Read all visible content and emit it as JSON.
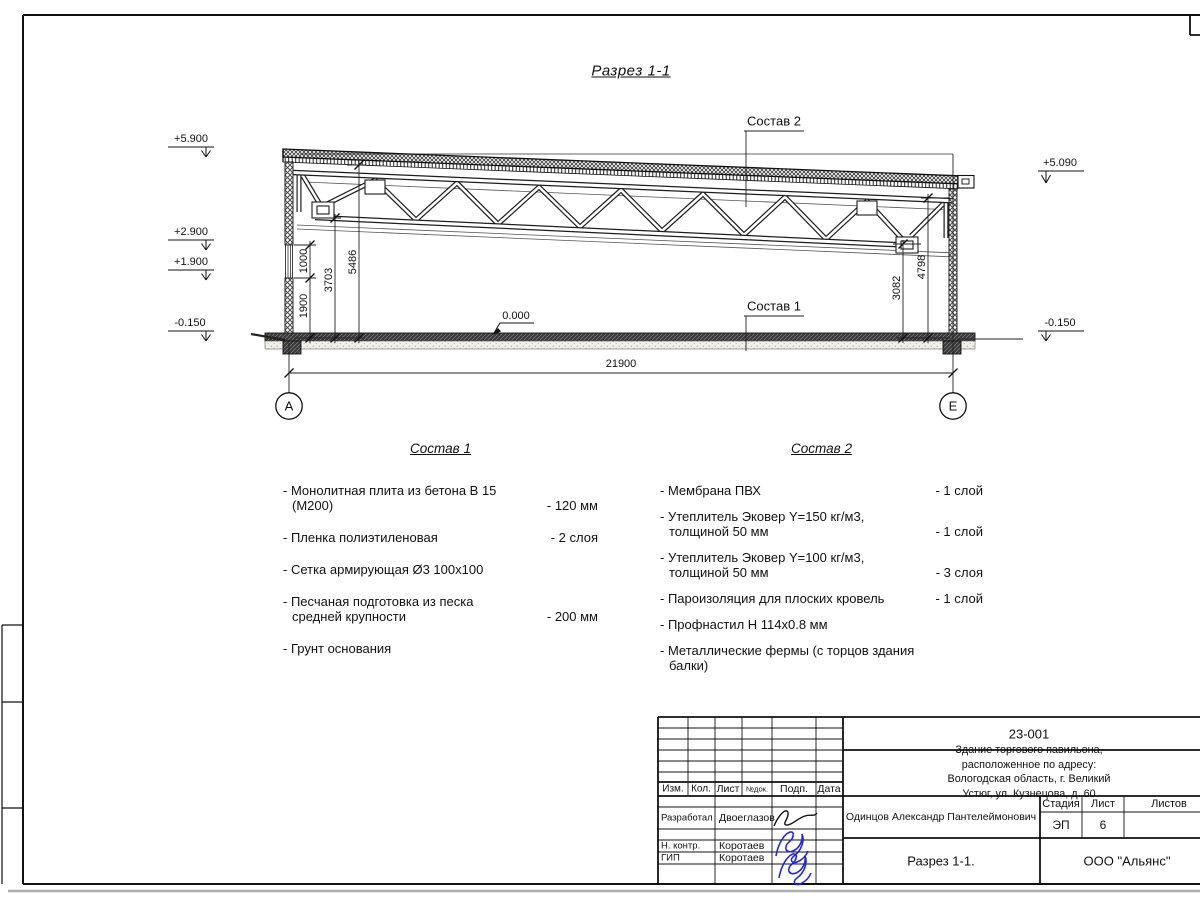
{
  "section": {
    "title": "Разрез 1-1",
    "composition1_label": "Состав 1",
    "composition2_label": "Состав 2",
    "zero_level": "0.000",
    "elevations": {
      "left_roof": "+5.900",
      "left_window_top": "+2.900",
      "left_window_sill": "+1.900",
      "left_ground": "-0.150",
      "right_roof": "+5.090",
      "right_ground": "-0.150"
    },
    "dimensions": {
      "wall_1900": "1900",
      "window_1000": "1000",
      "truss_bottom_left": "3703",
      "roof_left": "5486",
      "truss_bottom_right": "3082",
      "roof_right": "4798",
      "span_total": "21900"
    },
    "axes": {
      "left": "А",
      "right": "Е"
    }
  },
  "legend1": {
    "title": "Состав 1",
    "items": [
      {
        "name": "- Монолитная плита из бетона В 15 (М200)",
        "value": "- 120 мм"
      },
      {
        "name": "- Пленка полиэтиленовая",
        "value": "- 2 слоя"
      },
      {
        "name": "- Сетка армирующая Ø3 100х100",
        "value": ""
      },
      {
        "name": "- Песчаная подготовка из песка\nсредней крупности",
        "value": "- 200 мм"
      },
      {
        "name": "- Грунт основания",
        "value": ""
      }
    ]
  },
  "legend2": {
    "title": "Состав 2",
    "items": [
      {
        "name": "- Мембрана ПВХ",
        "value": "- 1 слой"
      },
      {
        "name": "- Утеплитель Эковер Y=150 кг/м3,\nтолщиной 50 мм",
        "value": "- 1 слой"
      },
      {
        "name": "- Утеплитель Эковер Y=100 кг/м3,\nтолщиной 50 мм",
        "value": "- 3 слоя"
      },
      {
        "name": "- Пароизоляция для плоских кровель",
        "value": "- 1 слой"
      },
      {
        "name": "- Профнастил Н 114х0.8 мм",
        "value": ""
      },
      {
        "name": "- Металлические фермы (с торцов здания балки)",
        "value": ""
      }
    ]
  },
  "title_block": {
    "document_number": "23-001",
    "project_description": "Здание торгового павильона, расположенное по адресу:\nВологодская область, г. Великий Устюг, ул. Кузнецова, д. 60",
    "columns": {
      "izm": "Изм.",
      "kol": "Кол.",
      "list": "Лист",
      "ndok": "№док.",
      "podp": "Подп.",
      "data": "Дата"
    },
    "rows": [
      {
        "role": "Разработал",
        "name": "Двоеглазов"
      },
      {
        "role": "Н. контр.",
        "name": "Коротаев"
      },
      {
        "role": "ГИП",
        "name": "Коротаев"
      }
    ],
    "author": "Одинцов Александр Пантелеймонович",
    "stage_label": "Стадия",
    "sheet_label": "Лист",
    "sheets_label": "Листов",
    "stage_value": "ЭП",
    "sheet_value": "6",
    "sheet_title": "Разрез 1-1.",
    "company": "ООО \"Альянс\""
  }
}
